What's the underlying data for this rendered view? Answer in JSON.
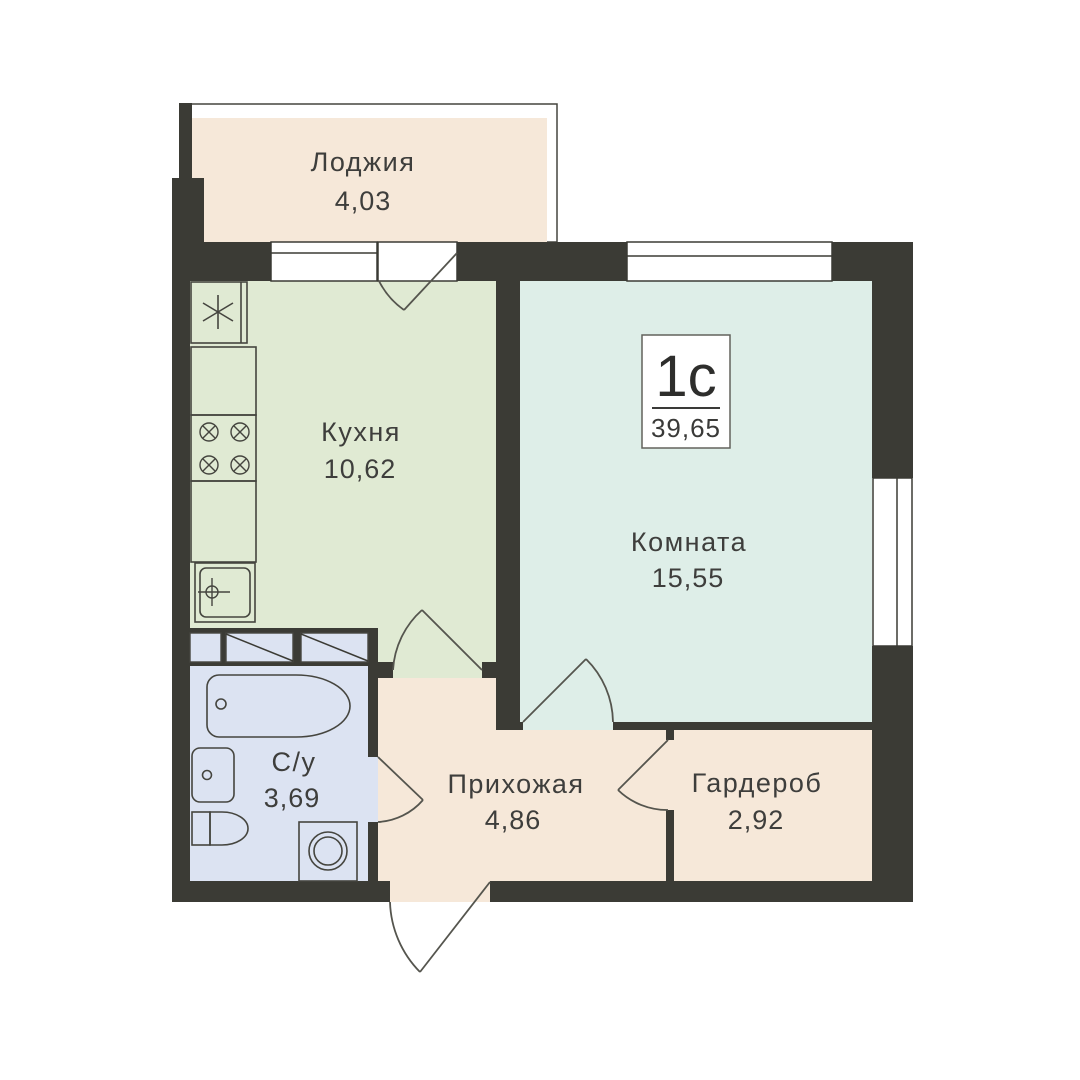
{
  "colors": {
    "wall": "#3b3b35",
    "background": "#ffffff",
    "loggia": "#f6e8d9",
    "kitchen": "#e0ead3",
    "living": "#deeee8",
    "bathroom": "#dce3f2",
    "hallway": "#f6e8d9",
    "wardrobe": "#f6e8d9",
    "text": "#3e3e3c"
  },
  "badge": {
    "type": "1с",
    "total_area": "39,65"
  },
  "rooms": {
    "loggia": {
      "name": "Лоджия",
      "area": "4,03"
    },
    "kitchen": {
      "name": "Кухня",
      "area": "10,62"
    },
    "living": {
      "name": "Комната",
      "area": "15,55"
    },
    "bathroom": {
      "name": "С/у",
      "area": "3,69"
    },
    "hallway": {
      "name": "Прихожая",
      "area": "4,86"
    },
    "wardrobe": {
      "name": "Гардероб",
      "area": "2,92"
    }
  }
}
